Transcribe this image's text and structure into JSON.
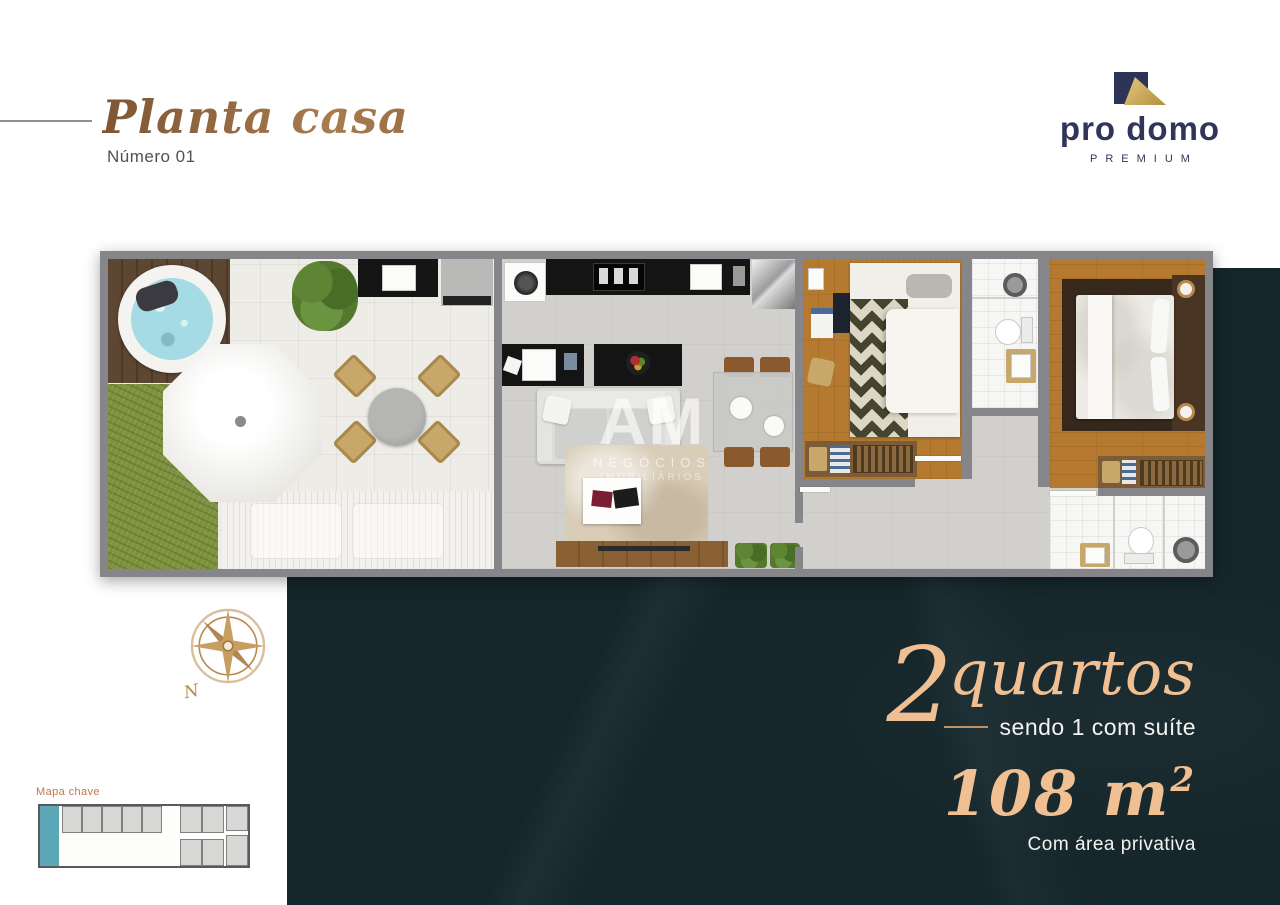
{
  "header": {
    "title": "Planta casa",
    "subtitle": "Número 01"
  },
  "logo": {
    "brand": "pro domo",
    "tagline": "PREMIUM"
  },
  "watermark": {
    "initials": "AM",
    "line1": "NEGÓCIOS",
    "line2": "IMOBILIÁRIOS"
  },
  "compass": {
    "north_label": "N"
  },
  "key_map": {
    "label": "Mapa chave",
    "highlight_color": "#5ca7b5"
  },
  "specs": {
    "bedrooms_number": "2",
    "bedrooms_label": "quartos",
    "suite_note": "sendo 1 com suíte",
    "area_value": "108 m",
    "area_superscript": "2",
    "area_note": "Com área privativa"
  },
  "colors": {
    "title_gold": "#96693f",
    "accent_peach": "#f0bf92",
    "logo_navy": "#2e3456",
    "panel_dark_green": "#15262b",
    "keymap_teal": "#5ca7b5",
    "keymap_label_orange": "#c4764f",
    "compass_gold": "#b98a4e",
    "wall_gray": "#85858a",
    "grass_green": "#7d9140",
    "wood_floor": "#b57a30"
  }
}
